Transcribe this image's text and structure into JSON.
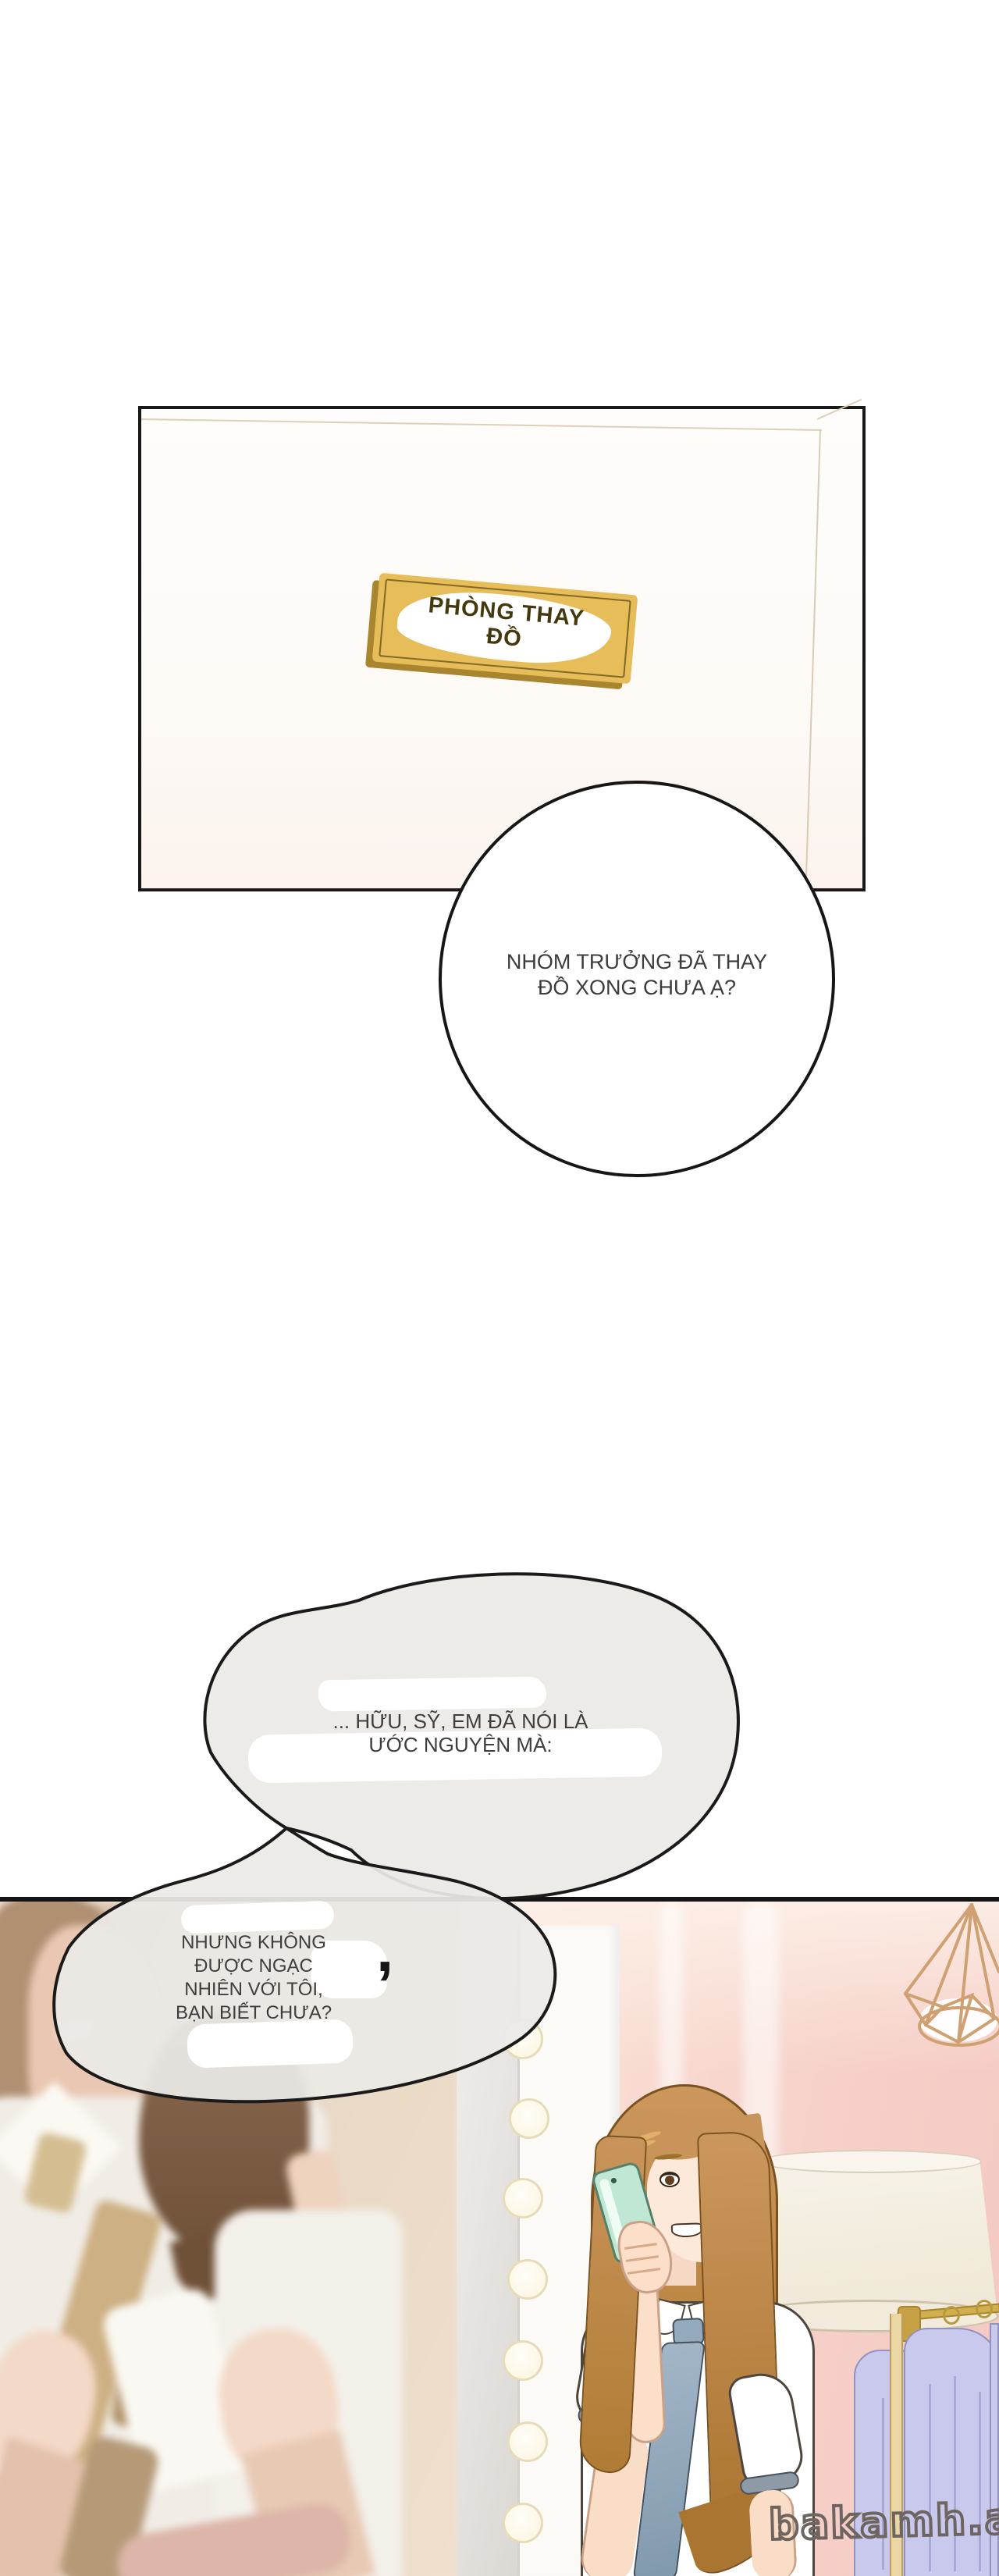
{
  "top_panel": {
    "door_sign": {
      "line1": "PHÒNG THAY",
      "line2": "ĐỒ",
      "plate_color": "#e6bd58",
      "edge_color": "#a8852e",
      "text_color": "#44380f"
    }
  },
  "dialogue": {
    "bubble1": {
      "line1": "NHÓM TRƯỞNG ĐÃ THAY",
      "line2": "ĐỒ XONG CHƯA Ạ?"
    },
    "bubble2": {
      "line1": "... HỮU, SỸ, EM ĐÃ NÓI LÀ",
      "line2": "ƯỚC NGUYỆN MÀ:"
    },
    "bubble3": {
      "line1": "NHƯNG KHÔNG",
      "line2": "ĐƯỢC NGẠC",
      "line3": "NHIÊN VỚI TÔI,",
      "line4": "BẠN BIẾT CHƯA?"
    },
    "stray_comma": ","
  },
  "scene": {
    "wall_pink": "#f6d0c9",
    "door_sign_plate": "#e6bd58",
    "mirror": {
      "frame": "#fbfaf7",
      "glass": "#e4e1de",
      "bulb_fill": "#fffdf2",
      "bulb_stroke": "#e7dcb8"
    },
    "woman_phone": {
      "hair": "#b9833f",
      "skin": "#fde9da",
      "shirt": "#ffffff",
      "tie": "#93a9bd",
      "phone": "#bfe7d3"
    },
    "couple": {
      "his_shirt": "#f1ede6",
      "his_tie": "#d4bd91",
      "her_hair": "#7f5e43",
      "skin": "#f3d9c7"
    },
    "lamp": {
      "shade": "#f4efe4",
      "pole": "#ead7a4"
    },
    "rack": {
      "gold": "#d2ae4e",
      "clothes": "#c9c9ed",
      "clothes_fold": "#a9a9d8"
    },
    "pendant": {
      "wire": "#cfa071"
    },
    "watermark": {
      "text": "bakamh.app",
      "color": "#6e6561"
    }
  }
}
